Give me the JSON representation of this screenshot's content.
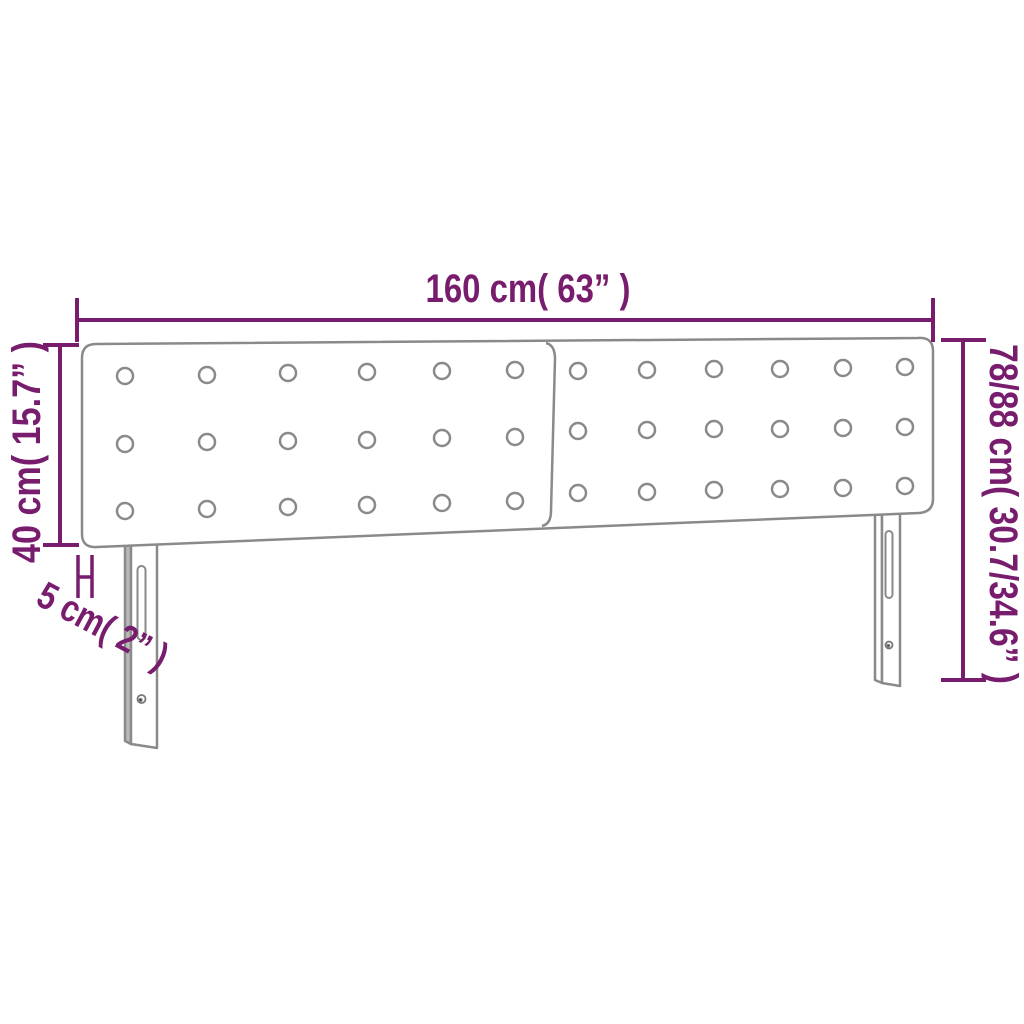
{
  "diagram": {
    "type": "product-dimension-diagram",
    "subject": "upholstered headboard with two tufted panels and two legs",
    "dimensions": {
      "width": {
        "label": "160 cm( 63” )",
        "cm": "160",
        "inch": "63"
      },
      "panel_height": {
        "label": "40 cm( 15.7” )",
        "cm": "40",
        "inch": "15.7"
      },
      "depth": {
        "label": "5 cm( 2” )",
        "cm": "5",
        "inch": "2"
      },
      "total_height": {
        "label": "78/88 cm( 30.7/34.6” )",
        "cm": "78/88",
        "inch": "30.7/34.6"
      }
    },
    "colors": {
      "dimension": "#781C6E",
      "outline": "#8a8a8a",
      "leg_side_shade": "#b9b9b9",
      "background": "#ffffff"
    }
  }
}
